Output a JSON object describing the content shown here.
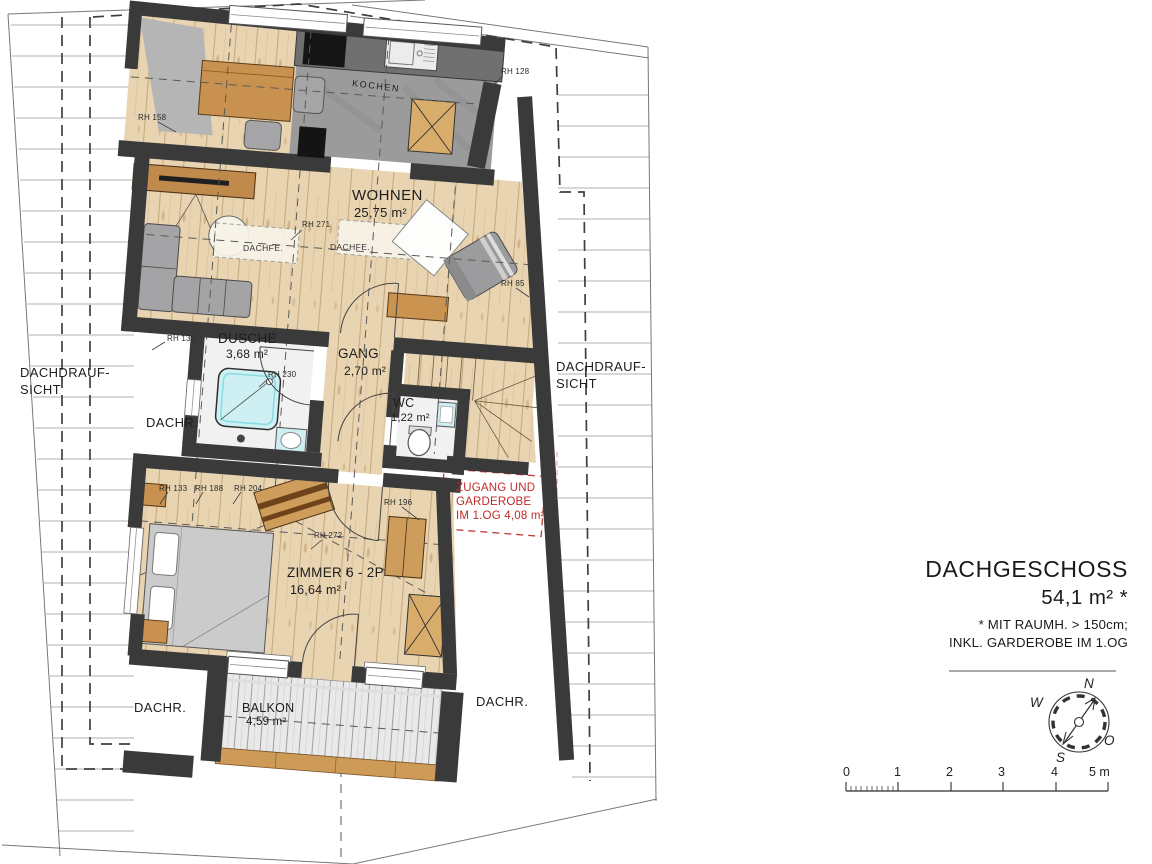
{
  "title_block": {
    "title": "DACHGESCHOSS",
    "area": "54,1 m² *",
    "note1": "* MIT RAUMH. > 150cm;",
    "note2": "INKL. GARDEROBE IM 1.OG"
  },
  "rooms": {
    "wohnen": {
      "name": "WOHNEN",
      "area": "25,75 m²"
    },
    "dusche": {
      "name": "DUSCHE",
      "area": "3,68 m²"
    },
    "gang": {
      "name": "GANG",
      "area": "2,70 m²"
    },
    "wc": {
      "name": "WC",
      "area": "1,22 m²"
    },
    "zimmer": {
      "name": "ZIMMER 6 - 2P",
      "area": "16,64 m²"
    },
    "balkon": {
      "name": "BALKON",
      "area": "4,59 m²"
    },
    "kochen": {
      "name": "KOCHEN"
    }
  },
  "red_note": {
    "line1": "ZUGANG UND",
    "line2": "GARDEROBE",
    "line3": "IM 1.OG 4,08 m²"
  },
  "side_labels": {
    "roof_view_line1": "DACHDRAUF-",
    "roof_view_line2": "SICHT",
    "dachr": "DACHR.",
    "dachfe": "DACHFE."
  },
  "rh_labels": {
    "rh158": "RH 158",
    "rh128": "RH 128",
    "rh271": "RH 271",
    "rh85": "RH 85",
    "rh130": "RH 130",
    "rh230": "RH 230",
    "rh133": "RH 133",
    "rh188": "RH 188",
    "rh204": "RH 204",
    "rh272": "RH 272",
    "rh196": "RH 196"
  },
  "compass": {
    "n": "N",
    "o": "O",
    "s": "S",
    "w": "W"
  },
  "scale_bar": {
    "t0": "0",
    "t1": "1",
    "t2": "2",
    "t3": "3",
    "t4": "4",
    "t5": "5 m"
  },
  "colors": {
    "wall": "#3a3a3a",
    "wood_floor": "#e9d4b2",
    "sanitary_cyan": "#cdeff3",
    "annotation_red": "#bf2b28"
  }
}
